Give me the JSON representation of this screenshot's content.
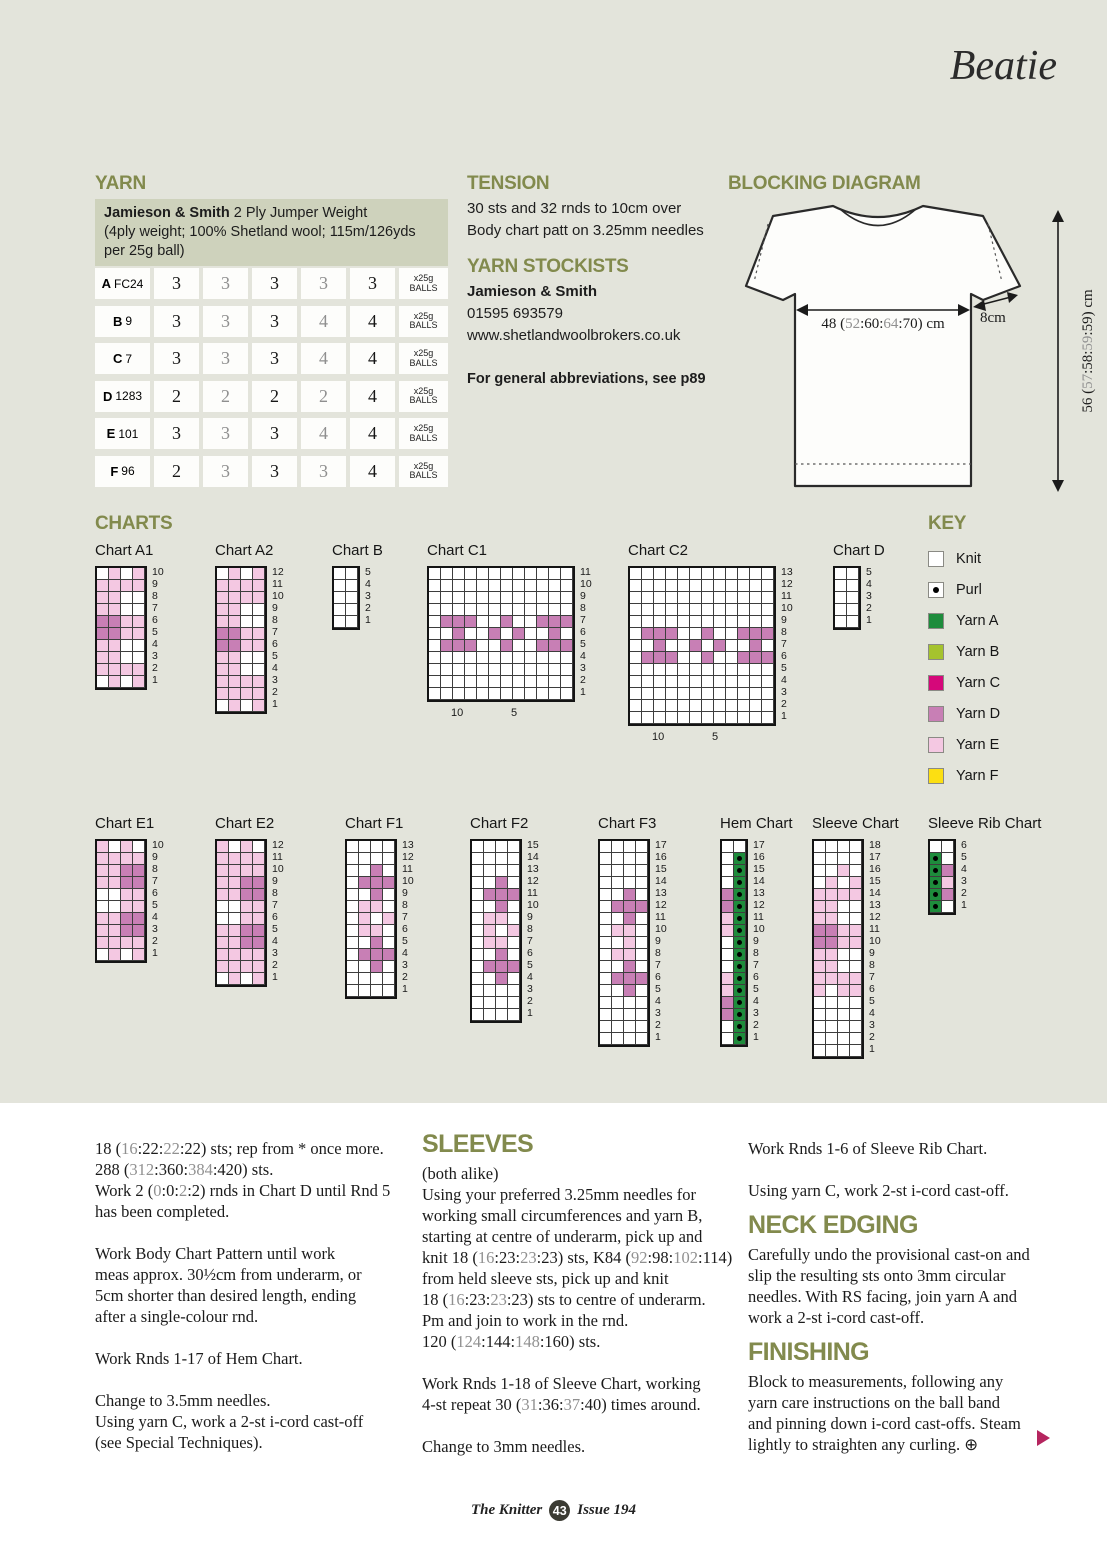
{
  "page": {
    "title": "Beatie"
  },
  "footer": {
    "magazine": "The Knitter",
    "page_number": "43",
    "issue": "Issue 194"
  },
  "colors": {
    "A": "#1e8c3c",
    "B": "#a5c32e",
    "C": "#d5087a",
    "D": "#c87fb5",
    "E": "#f4c8e2",
    "F": "#fcdf12",
    "knit": "#ffffff",
    "heading_olive": "#828a4d",
    "gray_number": "#909090",
    "band_bg": "#ced2bc",
    "page_bg": "#e3e4db",
    "accent_triangle": "#b5255f"
  },
  "yarn": {
    "heading": "YARN",
    "info_lines": [
      [
        {
          "t": "Jamieson & Smith",
          "b": 1
        },
        {
          "t": " 2 Ply Jumper Weight"
        }
      ],
      [
        {
          "t": "(4ply weight; 100% Shetland wool; 115m/126yds"
        }
      ],
      [
        {
          "t": "per 25g ball)"
        }
      ]
    ],
    "table": [
      {
        "label": "A",
        "code": "FC24",
        "values": [
          "3",
          "3",
          "3",
          "3",
          "3"
        ],
        "unit": [
          "x25g",
          "BALLS"
        ]
      },
      {
        "label": "B",
        "code": "9",
        "values": [
          "3",
          "3",
          "3",
          "4",
          "4"
        ],
        "unit": [
          "x25g",
          "BALLS"
        ]
      },
      {
        "label": "C",
        "code": "7",
        "values": [
          "3",
          "3",
          "3",
          "4",
          "4"
        ],
        "unit": [
          "x25g",
          "BALLS"
        ]
      },
      {
        "label": "D",
        "code": "1283",
        "values": [
          "2",
          "2",
          "2",
          "2",
          "4"
        ],
        "unit": [
          "x25g",
          "BALLS"
        ]
      },
      {
        "label": "E",
        "code": "101",
        "values": [
          "3",
          "3",
          "3",
          "4",
          "4"
        ],
        "unit": [
          "x25g",
          "BALLS"
        ]
      },
      {
        "label": "F",
        "code": "96",
        "values": [
          "2",
          "3",
          "3",
          "3",
          "4"
        ],
        "unit": [
          "x25g",
          "BALLS"
        ]
      }
    ]
  },
  "tension": {
    "heading": "TENSION",
    "lines": [
      "30 sts and 32 rnds to 10cm over",
      "Body chart patt on 3.25mm needles"
    ]
  },
  "stockists": {
    "heading": "YARN STOCKISTS",
    "name": "Jamieson & Smith",
    "phone": "01595 693579",
    "url": "www.shetlandwoolbrokers.co.uk",
    "note": "For general abbreviations, see p89"
  },
  "blocking": {
    "heading": "BLOCKING DIAGRAM",
    "width_label": [
      {
        "t": "48 ("
      },
      {
        "t": "52",
        "g": 1
      },
      {
        "t": ":"
      },
      {
        "t": "60"
      },
      {
        "t": ":"
      },
      {
        "t": "64",
        "g": 1
      },
      {
        "t": ":"
      },
      {
        "t": "70"
      },
      {
        "t": ") cm"
      }
    ],
    "sleeve_label": "8cm",
    "height_label": [
      {
        "t": "56 ("
      },
      {
        "t": "57",
        "g": 1
      },
      {
        "t": ":"
      },
      {
        "t": "58"
      },
      {
        "t": ":"
      },
      {
        "t": "59",
        "g": 1
      },
      {
        "t": ":"
      },
      {
        "t": "59"
      },
      {
        "t": ") cm"
      }
    ]
  },
  "charts_section": {
    "heading": "CHARTS"
  },
  "key": {
    "heading": "KEY",
    "items": [
      {
        "label": "Knit",
        "type": "knit"
      },
      {
        "label": "Purl",
        "type": "purl"
      },
      {
        "label": "Yarn A",
        "type": "A"
      },
      {
        "label": "Yarn B",
        "type": "B"
      },
      {
        "label": "Yarn C",
        "type": "C"
      },
      {
        "label": "Yarn D",
        "type": "D"
      },
      {
        "label": "Yarn E",
        "type": "E"
      },
      {
        "label": "Yarn F",
        "type": "F"
      }
    ]
  },
  "charts": [
    {
      "title": "Chart A1",
      "cols": 4,
      "grid": [
        "GEGE",
        "EEEE",
        "EEMM",
        "EEMM",
        "DDEE",
        "DDEE",
        "EEMM",
        "EEMM",
        "EEEE",
        "GEGE"
      ]
    },
    {
      "title": "Chart A2",
      "cols": 4,
      "grid": [
        "GEGE",
        "EEEE",
        "EEEE",
        "EEMM",
        "EEMM",
        "DDEE",
        "DDEE",
        "EEMM",
        "EEMM",
        "EEEE",
        "EEEE",
        "GEGE"
      ]
    },
    {
      "title": "Chart B",
      "cols": 2,
      "grid": [
        "GG",
        "GK",
        "KK",
        "KG",
        "GG"
      ]
    },
    {
      "title": "Chart C1",
      "cols": 12,
      "below": [
        {
          "text": "10",
          "col": 2
        },
        {
          "text": "5",
          "col": 7
        }
      ],
      "grid": [
        "YGYGGYGYGGYG",
        "YYYYYYYYYYYY",
        "YYMYYYMYYYMY",
        "YMMMYMMMYMMM",
        "MDDDMMDMMDDD",
        "MMDMMDMDMMDM",
        "MDDDMMDMMDDD",
        "YMMMYMMMYMMM",
        "YYMYYYMYYYMY",
        "YYYYYYYYYYYY",
        "YGYGGYGYGGYG"
      ]
    },
    {
      "title": "Chart C2",
      "cols": 12,
      "below": [
        {
          "text": "10",
          "col": 2
        },
        {
          "text": "5",
          "col": 7
        }
      ],
      "grid": [
        "YGYGYGYYGYGY",
        "YYYYYYYYYYYY",
        "YYYYYYYYYYYY",
        "YYMYYYMYYYMY",
        "YMMMYMMMYMMM",
        "MDDDMMDMMDDD",
        "MMDMMDMDMMDM",
        "MDDDMMDMMDDD",
        "YMMMYMMMYMMM",
        "YYMYYYMYYYMY",
        "YYYYYYYYYYYY",
        "YYYYYYYYYYYY",
        "YGYGYGYYGYGY"
      ]
    },
    {
      "title": "Chart D",
      "cols": 2,
      "grid": [
        "GG",
        "KG",
        "KK",
        "GK",
        "GG"
      ]
    },
    {
      "title": "Chart E1",
      "cols": 4,
      "grid": [
        "EGEG",
        "EEEE",
        "EEDD",
        "EEDD",
        "MMEE",
        "MMEE",
        "EEDD",
        "EEDD",
        "EEEE",
        "GEGE"
      ]
    },
    {
      "title": "Chart E2",
      "cols": 4,
      "grid": [
        "EGEG",
        "EEEE",
        "EEEE",
        "EEDD",
        "EEDD",
        "MMEE",
        "MMEE",
        "EEDD",
        "EEDD",
        "EEEE",
        "EEEE",
        "GEGE"
      ]
    },
    {
      "title": "Chart F1",
      "cols": 4,
      "grid": [
        "YGYG",
        "YYYY",
        "YYDY",
        "YDDD",
        "YYDY",
        "MEEY",
        "MEME",
        "MEEY",
        "YYDY",
        "YDDD",
        "YYDY",
        "YYYY",
        "GYGY"
      ]
    },
    {
      "title": "Chart F2",
      "cols": 4,
      "grid": [
        "YYYG",
        "YYYY",
        "YYYY",
        "YYDY",
        "YDDD",
        "YYDY",
        "MEEY",
        "MEME",
        "MEEY",
        "YYDY",
        "YDDD",
        "YYDY",
        "YYYY",
        "YYYY",
        "YGYG"
      ]
    },
    {
      "title": "Chart F3",
      "cols": 4,
      "grid": [
        "YGYG",
        "YYYY",
        "YYYY",
        "YYYY",
        "YYDY",
        "YDDD",
        "YYDY",
        "MEEY",
        "MMEM",
        "MEEY",
        "YYDY",
        "YDDD",
        "YYDY",
        "YYYY",
        "YYYY",
        "YYYY",
        "GYGY"
      ]
    },
    {
      "title": "Hem Chart",
      "cols": 2,
      "grid": [
        "MM",
        "MP",
        "MP",
        "MP",
        "DP",
        "DP",
        "EP",
        "EP",
        "YP",
        "GP",
        "YP",
        "EP",
        "EP",
        "DP",
        "DP",
        "MP",
        "MP"
      ]
    },
    {
      "title": "Sleeve Chart",
      "cols": 4,
      "grid": [
        "KKKK",
        "KGKG",
        "GGEG",
        "GEGE",
        "EEEE",
        "EEMM",
        "EEMM",
        "DDEE",
        "DDEE",
        "EEMM",
        "EEMM",
        "EEEE",
        "EGEE",
        "GGGG",
        "KGKK",
        "KKKK",
        "KGGK",
        "GGGG"
      ]
    },
    {
      "title": "Sleeve Rib Chart",
      "cols": 2,
      "grid": [
        "MM",
        "PM",
        "PD",
        "PE",
        "PD",
        "PM"
      ]
    }
  ],
  "instructions": {
    "col1": {
      "blocks": [
        {
          "l": [
            {
              "t": "18 ("
            },
            {
              "t": "16",
              "g": 1
            },
            {
              "t": ":"
            },
            {
              "t": "22"
            },
            {
              "t": ":"
            },
            {
              "t": "22",
              "g": 1
            },
            {
              "t": ":"
            },
            {
              "t": "22"
            },
            {
              "t": ") sts; rep from * once more."
            }
          ]
        },
        {
          "l": [
            {
              "t": "288 ("
            },
            {
              "t": "312",
              "g": 1
            },
            {
              "t": ":"
            },
            {
              "t": "360"
            },
            {
              "t": ":"
            },
            {
              "t": "384",
              "g": 1
            },
            {
              "t": ":"
            },
            {
              "t": "420"
            },
            {
              "t": ") sts."
            }
          ]
        },
        {
          "l": [
            {
              "t": "Work 2 ("
            },
            {
              "t": "0",
              "g": 1
            },
            {
              "t": ":"
            },
            {
              "t": "0"
            },
            {
              "t": ":"
            },
            {
              "t": "2",
              "g": 1
            },
            {
              "t": ":"
            },
            {
              "t": "2"
            },
            {
              "t": ") rnds in Chart D until Rnd 5"
            }
          ]
        },
        {
          "l": [
            {
              "t": "has been completed."
            }
          ]
        },
        {
          "gap": 1
        },
        {
          "l": [
            {
              "t": "Work Body Chart Pattern until work"
            }
          ]
        },
        {
          "l": [
            {
              "t": "meas approx. 30½cm from underarm, or"
            }
          ]
        },
        {
          "l": [
            {
              "t": "5cm shorter than desired length, ending"
            }
          ]
        },
        {
          "l": [
            {
              "t": "after a single-colour rnd."
            }
          ]
        },
        {
          "gap": 1
        },
        {
          "l": [
            {
              "t": "Work Rnds 1-17 of Hem Chart."
            }
          ]
        },
        {
          "gap": 1
        },
        {
          "l": [
            {
              "t": "Change to 3.5mm needles."
            }
          ]
        },
        {
          "l": [
            {
              "t": "Using yarn C, work a 2-st i-cord cast-off"
            }
          ]
        },
        {
          "l": [
            {
              "t": "(see Special Techniques)."
            }
          ]
        }
      ]
    },
    "col2": {
      "blocks": [
        {
          "h": "SLEEVES",
          "first": 1
        },
        {
          "l": [
            {
              "t": "(both alike)"
            }
          ]
        },
        {
          "l": [
            {
              "t": "Using your preferred 3.25mm needles for"
            }
          ]
        },
        {
          "l": [
            {
              "t": "working small circumferences and yarn B,"
            }
          ]
        },
        {
          "l": [
            {
              "t": "starting at centre of underarm, pick up and"
            }
          ]
        },
        {
          "l": [
            {
              "t": "knit 18 ("
            },
            {
              "t": "16",
              "g": 1
            },
            {
              "t": ":"
            },
            {
              "t": "23"
            },
            {
              "t": ":"
            },
            {
              "t": "23",
              "g": 1
            },
            {
              "t": ":"
            },
            {
              "t": "23"
            },
            {
              "t": ") sts, K84 ("
            },
            {
              "t": "92",
              "g": 1
            },
            {
              "t": ":"
            },
            {
              "t": "98"
            },
            {
              "t": ":"
            },
            {
              "t": "102",
              "g": 1
            },
            {
              "t": ":"
            },
            {
              "t": "114"
            },
            {
              "t": ")"
            }
          ]
        },
        {
          "l": [
            {
              "t": "from held sleeve sts, pick up and knit"
            }
          ]
        },
        {
          "l": [
            {
              "t": "18 ("
            },
            {
              "t": "16",
              "g": 1
            },
            {
              "t": ":"
            },
            {
              "t": "23"
            },
            {
              "t": ":"
            },
            {
              "t": "23",
              "g": 1
            },
            {
              "t": ":"
            },
            {
              "t": "23"
            },
            {
              "t": ") sts to centre of underarm."
            }
          ]
        },
        {
          "l": [
            {
              "t": "Pm and join to work in the rnd."
            }
          ]
        },
        {
          "l": [
            {
              "t": "120 ("
            },
            {
              "t": "124",
              "g": 1
            },
            {
              "t": ":"
            },
            {
              "t": "144"
            },
            {
              "t": ":"
            },
            {
              "t": "148",
              "g": 1
            },
            {
              "t": ":"
            },
            {
              "t": "160"
            },
            {
              "t": ") sts."
            }
          ]
        },
        {
          "gap": 1
        },
        {
          "l": [
            {
              "t": "Work Rnds 1-18 of Sleeve Chart, working"
            }
          ]
        },
        {
          "l": [
            {
              "t": "4-st repeat 30 ("
            },
            {
              "t": "31",
              "g": 1
            },
            {
              "t": ":"
            },
            {
              "t": "36"
            },
            {
              "t": ":"
            },
            {
              "t": "37",
              "g": 1
            },
            {
              "t": ":"
            },
            {
              "t": "40"
            },
            {
              "t": ") times around."
            }
          ]
        },
        {
          "gap": 1
        },
        {
          "l": [
            {
              "t": "Change to 3mm needles."
            }
          ]
        }
      ]
    },
    "col3": {
      "blocks": [
        {
          "l": [
            {
              "t": "Work Rnds 1-6 of Sleeve Rib Chart."
            }
          ]
        },
        {
          "gap": 1
        },
        {
          "l": [
            {
              "t": "Using yarn C, work 2-st i-cord cast-off."
            }
          ]
        },
        {
          "h": "NECK EDGING"
        },
        {
          "l": [
            {
              "t": "Carefully undo the provisional cast-on and"
            }
          ]
        },
        {
          "l": [
            {
              "t": "slip the resulting sts onto 3mm circular"
            }
          ]
        },
        {
          "l": [
            {
              "t": "needles. With RS facing, join yarn A and"
            }
          ]
        },
        {
          "l": [
            {
              "t": "work a 2-st i-cord cast-off."
            }
          ]
        },
        {
          "h": "FINISHING"
        },
        {
          "l": [
            {
              "t": "Block to measurements, following any"
            }
          ]
        },
        {
          "l": [
            {
              "t": "yarn care instructions on the ball band"
            }
          ]
        },
        {
          "l": [
            {
              "t": "and pinning down i-cord cast-offs. Steam"
            }
          ]
        },
        {
          "l": [
            {
              "t": "lightly to straighten any curling. ⊕"
            }
          ]
        }
      ]
    }
  }
}
